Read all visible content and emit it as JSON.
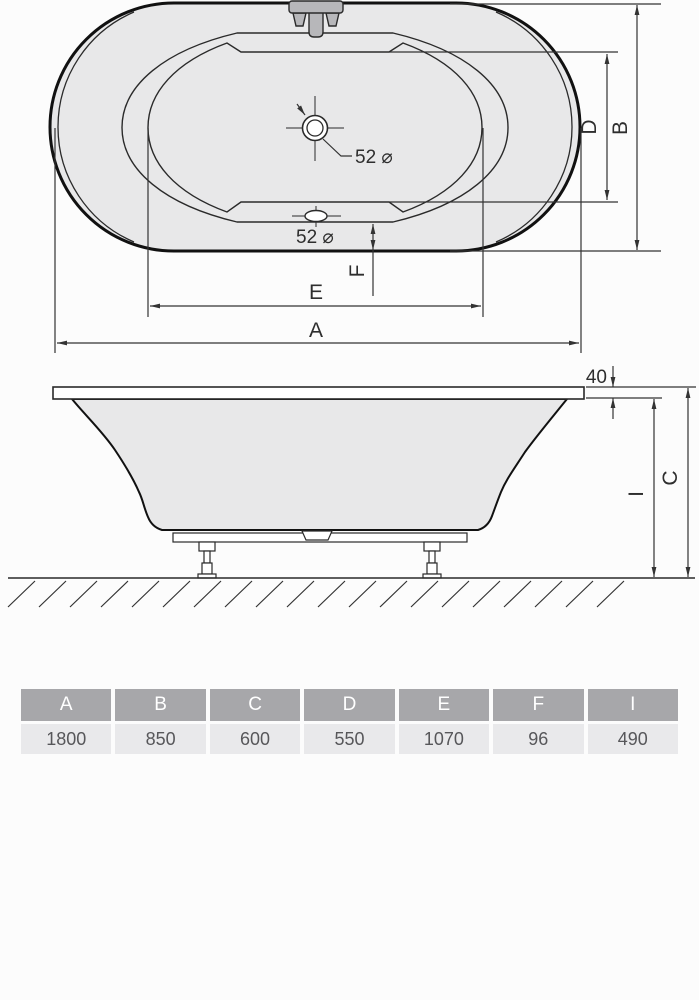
{
  "colors": {
    "bg": "#fcfcfc",
    "tub_fill": "#e8e8e9",
    "fixture_fill": "#b7b7ba",
    "line": "#2a2a2a",
    "line_thick": "#111111",
    "dim": "#2e2e2e",
    "table_header_bg": "#a7a7aa",
    "table_header_text": "#ffffff",
    "table_value_bg": "#e9e9eb",
    "table_value_text": "#57575a"
  },
  "top_view": {
    "dim_a": "A",
    "dim_b": "B",
    "dim_d": "D",
    "dim_e": "E",
    "dim_f": "F",
    "drain_main_label": "52 ⌀",
    "overflow_label": "52 ⌀"
  },
  "side_view": {
    "dim_c": "C",
    "dim_i": "I",
    "rim_thickness": "40"
  },
  "table": {
    "headers": [
      "A",
      "B",
      "C",
      "D",
      "E",
      "F",
      "I"
    ],
    "values": [
      "1800",
      "850",
      "600",
      "550",
      "1070",
      "96",
      "490"
    ]
  }
}
